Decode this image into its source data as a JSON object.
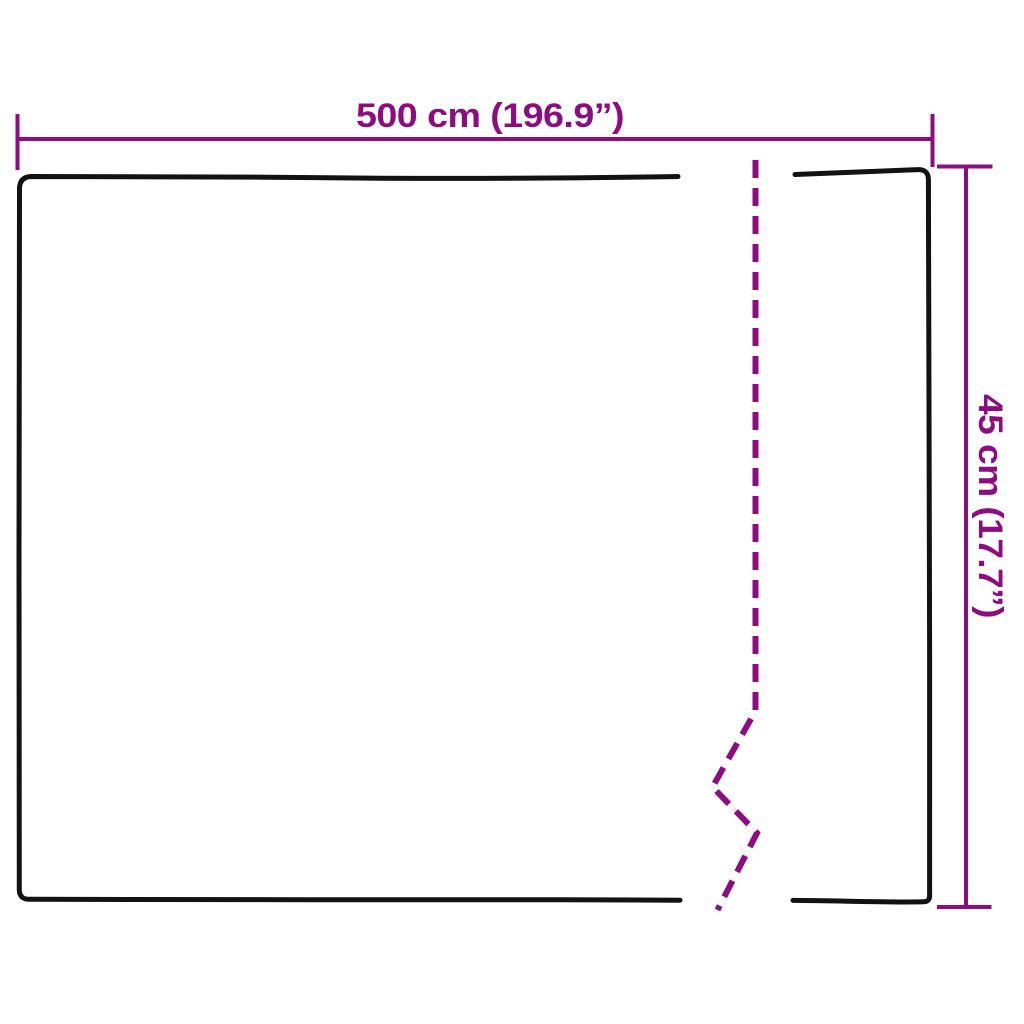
{
  "diagram": {
    "kind": "product-dimension-diagram",
    "width_dimension": {
      "label": "500 cm (196.9”)",
      "cm": 500,
      "inches": 196.9
    },
    "height_dimension": {
      "label": "45 cm (17.7”)",
      "cm": 45,
      "inches": 17.7
    },
    "colors": {
      "accent": "#8d0c7f",
      "line": "#121212",
      "background": "#ffffff"
    }
  }
}
